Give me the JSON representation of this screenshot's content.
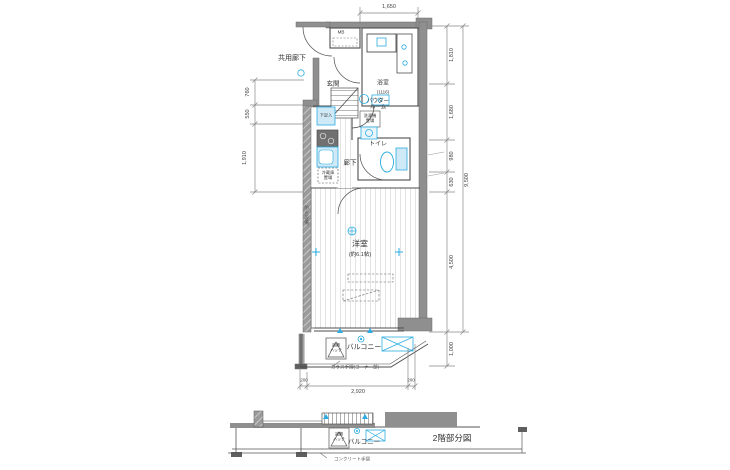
{
  "colors": {
    "wall": "#8f8f8f",
    "wall_dark": "#5f5f5f",
    "line": "#4d4d4d",
    "dim_line": "#888888",
    "fixture": "#2BACE2",
    "fixture_light": "#cfe9f6",
    "floor_line": "#dcdcdc",
    "text": "#333333"
  },
  "plan": {
    "common_corridor": "共用廊下",
    "mb": "MB",
    "bathroom": "浴室",
    "bathroom_size": "(1116)",
    "entrance": "玄関",
    "shoe_box": "下足入",
    "powder_room": "パウダー\nルーム",
    "washer": "洗濯機\n置場",
    "toilet": "トイレ",
    "hallway": "廊下",
    "fridge": "冷蔵庫\n置場",
    "main_room": "洋室",
    "main_room_size": "(約6.1帖)",
    "balcony": "バルコニー",
    "escape_hatch": "避難\nハッチ",
    "fire_wall": "防火設備",
    "glass_rail_note": "ガラス手摺(コーナー部)"
  },
  "partial_plan": {
    "caption": "2階部分図",
    "balcony": "バルコニー",
    "escape_hatch": "避難\nハッチ",
    "concrete_rail_note": "コンクリート手摺"
  },
  "dimensions": {
    "top_width": "1,650",
    "left": [
      "760",
      "550",
      "1,910"
    ],
    "right": [
      "1,810",
      "1,680",
      "980",
      "630",
      "4,500",
      "1,000"
    ],
    "right_total": "9,500",
    "bottom": [
      "200",
      "2,920",
      "200"
    ]
  }
}
